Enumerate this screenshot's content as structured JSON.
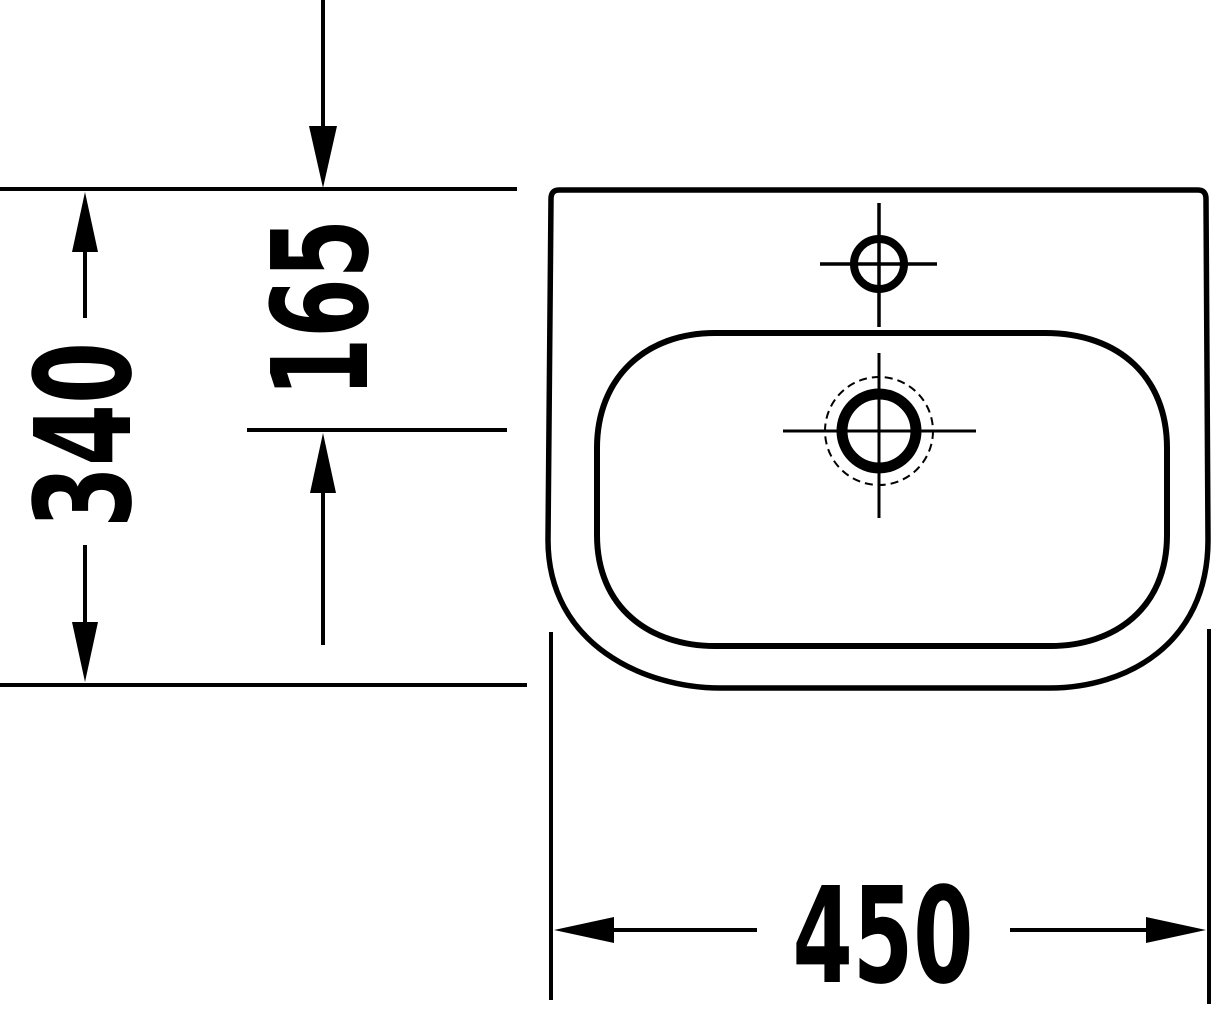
{
  "drawing": {
    "title": "washbasin-top-view-dimension-drawing",
    "colors": {
      "line": "#000000",
      "background": "#ffffff"
    },
    "dimension_labels": {
      "overall_depth": "340",
      "drain_offset": "165",
      "overall_width": "450"
    }
  }
}
